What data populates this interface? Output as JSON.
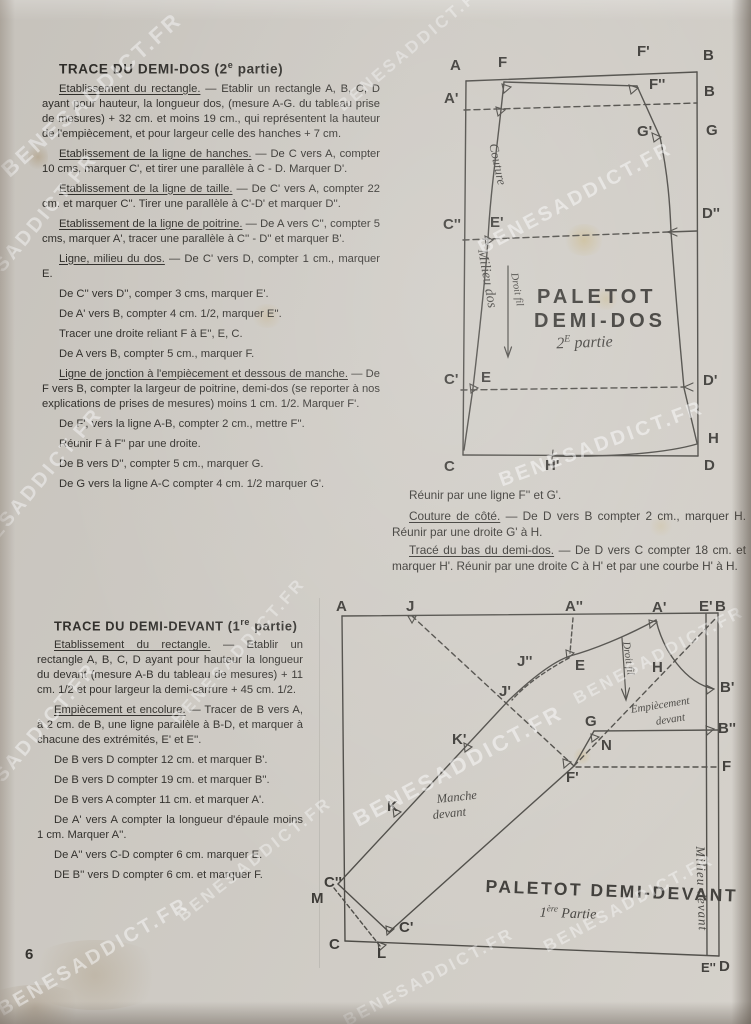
{
  "page": {
    "number": "6",
    "watermark": "BENESADDICT.FR"
  },
  "col1": {
    "title_pre": "TRACE DU DEMI-DOS (2",
    "title_sup": "e",
    "title_post": " partie)",
    "paragraphs": [
      {
        "head": "Etablissement du rectangle.",
        "body": " — Etablir un rectangle A, B, C, D ayant pour hauteur, la longueur dos, (mesure A-G. du tableau prise de mesures) + 32 cm. et moins 19 cm., qui représentent la hauteur de l'empiècement, et pour largeur celle des hanches + 7 cm."
      },
      {
        "head": "Etablissement de la ligne de hanches.",
        "body": " — De C vers A, compter 10 cms, marquer C', et tirer une parallèle à C - D. Marquer D'."
      },
      {
        "head": "Etablissement de la ligne de taille.",
        "body": " — De C' vers A, compter 22 cm. et marquer C''. Tirer une parallèle à C'-D' et marquer D''."
      },
      {
        "head": "Etablissement de la ligne de poitrine.",
        "body": " — De A vers C'', compter 5 cms, marquer A', tracer une parallèle à C'' - D'' et marquer B'."
      },
      {
        "head": "Ligne, milieu du dos.",
        "body": " — De C' vers D, compter 1 cm., marquer E."
      },
      {
        "body": "De C'' vers D'', comper 3 cms, marquer E'."
      },
      {
        "body": "De A' vers B, compter 4 cm. 1/2, marquer E''."
      },
      {
        "body": "Tracer une droite reliant F à E'', E, C."
      },
      {
        "body": "De A vers B, compter 5 cm., marquer F."
      },
      {
        "head": "Ligne de jonction à l'empiècement et dessous de manche.",
        "body": " — De F vers B, compter la largeur de poitrine, demi-dos (se reporter à nos explications de prises de mesures) moins 1 cm. 1/2. Marquer F'."
      },
      {
        "body": "De F', vers la ligne A-B, compter 2 cm., mettre F''."
      },
      {
        "body": "Réunir F à F'' par une droite."
      },
      {
        "body": "De B vers D'', compter 5 cm., marquer G."
      },
      {
        "body": "De G vers la ligne A-C compter 4 cm. 1/2 marquer G'."
      }
    ]
  },
  "colside": {
    "paragraphs": [
      {
        "body": "Réunir par une ligne F'' et G'."
      },
      {
        "head": "Couture de côté.",
        "body": " — De D vers B compter 2 cm., marquer H. Réunir par une droite G' à H."
      },
      {
        "head": "Tracé du bas du demi-dos.",
        "body": " — De D vers C compter 18 cm. et marquer H'. Réunir par une droite C à H' et par une courbe H' à H."
      }
    ]
  },
  "col2": {
    "title_pre": "TRACE DU DEMI-DEVANT (1",
    "title_sup": "re",
    "title_post": " partie)",
    "paragraphs": [
      {
        "head": "Etablissement du rectangle.",
        "body": " — Etablir un rectangle A, B, C, D ayant pour hauteur la longueur du devant (mesure A-B du tableau de mesures) + 11 cm. 1/2 et pour largeur la demi-carrure + 45 cm. 1/2."
      },
      {
        "head": "Empiècement et encolure.",
        "body": " — Tracer de B vers A, à 2 cm. de B, une ligne parallèle à B-D, et marquer à chacune des extrémités, E' et E''."
      },
      {
        "body": "De B vers D compter 12 cm. et marquer B'."
      },
      {
        "body": "De B vers D compter 19 cm. et marquer B''."
      },
      {
        "body": "De B vers A compter 11 cm. et marquer A'."
      },
      {
        "body": "De A' vers A compter la longueur d'épaule moins 1 cm. Marquer A''."
      },
      {
        "body": "De A'' vers C-D compter 6 cm. marquer E."
      },
      {
        "body": "DE B'' vers D compter 6 cm. et marquer F."
      }
    ]
  },
  "diagram1": {
    "points": {
      "A": "A",
      "F": "F",
      "Fp": "F'",
      "B": "B",
      "Ap": "A'",
      "Fpp": "F''",
      "B2": "B",
      "Gp": "G'",
      "G": "G",
      "Cpp": "C''",
      "Ep": "E'",
      "Dpp": "D''",
      "Cp": "C'",
      "E": "E",
      "Dp": "D'",
      "H": "H",
      "C": "C",
      "Hp": "H'",
      "D": "D"
    },
    "couture": "Couture",
    "milieu": "Milieu dos",
    "droitfil": "Droit fil",
    "title1": "PALETOT",
    "title2": "DEMI-DOS",
    "sub_pre": "2",
    "sub_sup": "E",
    "sub_post": " partie"
  },
  "diagram2": {
    "points": {
      "A": "A",
      "J": "J",
      "App": "A''",
      "Ap": "A'",
      "Epr": "E'",
      "B": "B",
      "E": "E",
      "Jpp": "J''",
      "Jp": "J'",
      "H": "H",
      "G": "G",
      "N": "N",
      "Kp": "K'",
      "K": "K",
      "Fp": "F'",
      "Cpp": "C''",
      "M": "M",
      "C": "C",
      "L": "L",
      "Cp": "C'",
      "Bp": "B'",
      "Bpp": "B''",
      "F": "F",
      "Epp": "E''",
      "D": "D"
    },
    "droitfil": "Droit fil",
    "empiece1": "Empiècement",
    "empiece2": "devant",
    "manche1": "Manche",
    "manche2": "devant",
    "milieu": "Milieu devant",
    "title": "PALETOT DEMI-DEVANT",
    "sub_pre": "1",
    "sub_sup": "ère",
    "sub_post": " Partie"
  }
}
